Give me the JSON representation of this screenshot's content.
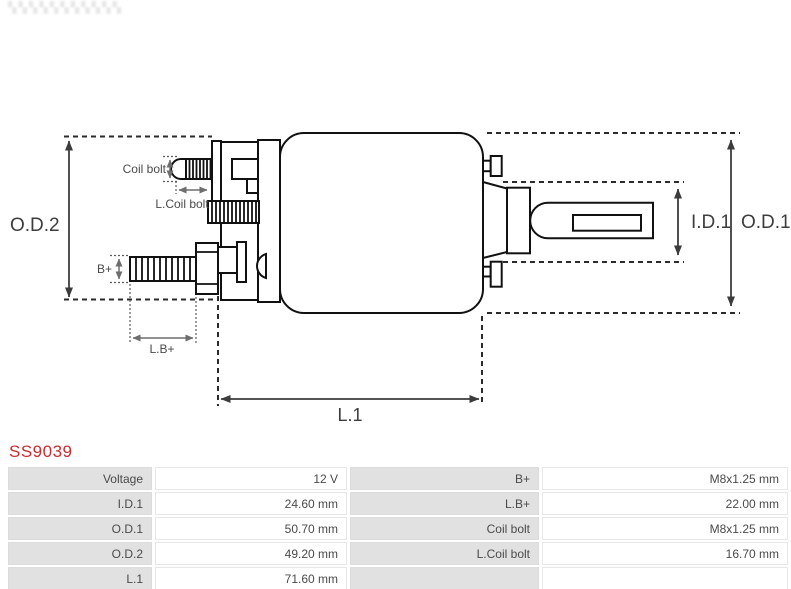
{
  "part_number": {
    "text": "SS9039",
    "color": "#c62d33"
  },
  "diagram": {
    "dim_labels": {
      "od2": "O.D.2",
      "od1": "O.D.1",
      "id1": "I.D.1",
      "l1": "L.1",
      "coil_bolt": "Coil bolt",
      "l_coil_bolt": "L.Coil bolt",
      "b_plus": "B+",
      "l_b_plus": "L.B+"
    },
    "outline_color": "#111111",
    "dimension_color": "#3c3c3c",
    "small_dimension_color": "#6e6e6e"
  },
  "spec_table": {
    "left_rows": [
      {
        "label": "Voltage",
        "value": "12 V"
      },
      {
        "label": "I.D.1",
        "value": "24.60 mm"
      },
      {
        "label": "O.D.1",
        "value": "50.70 mm"
      },
      {
        "label": "O.D.2",
        "value": "49.20 mm"
      },
      {
        "label": "L.1",
        "value": "71.60 mm"
      }
    ],
    "right_rows": [
      {
        "label": "B+",
        "value": "M8x1.25 mm"
      },
      {
        "label": "L.B+",
        "value": "22.00 mm"
      },
      {
        "label": "Coil bolt",
        "value": "M8x1.25 mm"
      },
      {
        "label": "L.Coil bolt",
        "value": "16.70 mm"
      },
      {
        "label": "",
        "value": ""
      }
    ]
  }
}
